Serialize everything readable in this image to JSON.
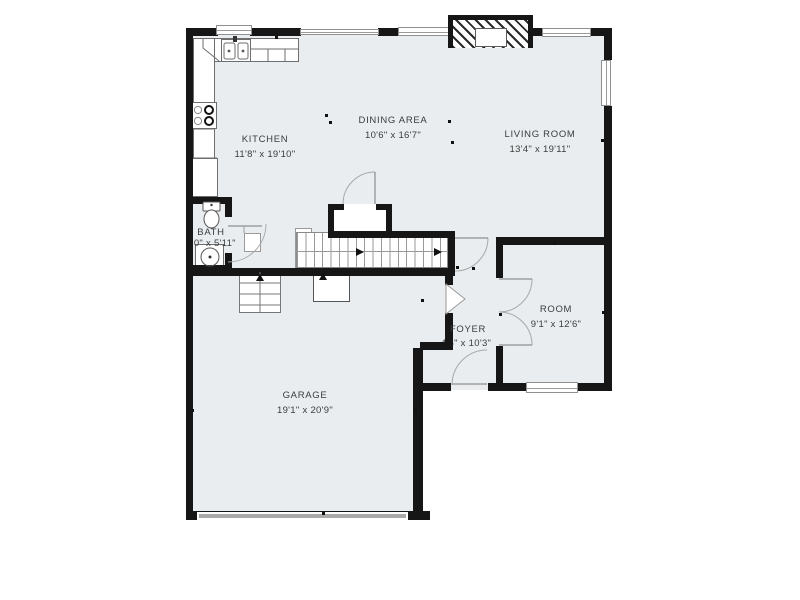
{
  "plan": {
    "type": "floor-plan",
    "background": "#ffffff",
    "floor_color": "#e9edf0",
    "wall_color": "#161616",
    "line_color": "#9a9a9a",
    "text_color": "#3c3c3c",
    "rooms": [
      {
        "id": "kitchen",
        "name": "KITCHEN",
        "dims": "11'8\" x 19'10\""
      },
      {
        "id": "dining",
        "name": "DINING AREA",
        "dims": "10'6\" x 16'7\""
      },
      {
        "id": "living",
        "name": "LIVING ROOM",
        "dims": "13'4\" x 19'11\""
      },
      {
        "id": "bath",
        "name": "BATH",
        "dims": "5'0\" x 5'11\""
      },
      {
        "id": "foyer",
        "name": "FOYER",
        "dims": "4'6\" x 10'3\""
      },
      {
        "id": "room",
        "name": "ROOM",
        "dims": "9'1\" x 12'6\""
      },
      {
        "id": "garage",
        "name": "GARAGE",
        "dims": "19'1\" x 20'9\""
      }
    ],
    "features": [
      "fireplace",
      "stairs",
      "french-doors",
      "garage-door",
      "kitchen-sink",
      "stove",
      "refrigerator",
      "toilet",
      "vanity-sink"
    ]
  }
}
